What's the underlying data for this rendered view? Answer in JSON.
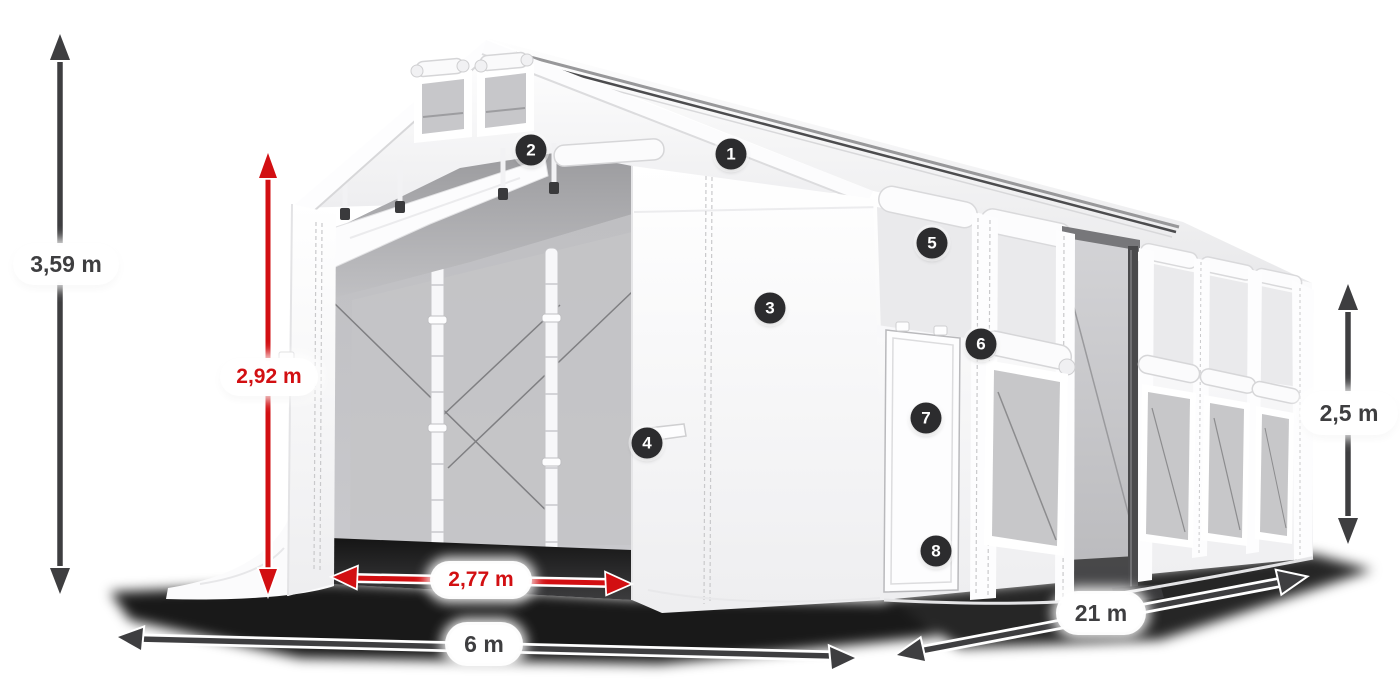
{
  "diagram": {
    "type": "product-dimension-diagram",
    "subject": "white marquee tent with open front entrance, side door and mesh windows",
    "dimension_labels": {
      "total_height": "3,59 m",
      "entrance_height": "2,92 m",
      "entrance_width": "2,77 m",
      "width": "6 m",
      "length": "21 m",
      "side_wall_height": "2,5 m"
    },
    "feature_markers": [
      "1",
      "2",
      "3",
      "4",
      "5",
      "6",
      "7",
      "8"
    ],
    "colors": {
      "dimension_primary": "#3e3e40",
      "dimension_accent_red": "#d20f12",
      "marker_background": "#2c2c2e",
      "marker_text": "#ffffff",
      "background": "#ffffff"
    }
  }
}
